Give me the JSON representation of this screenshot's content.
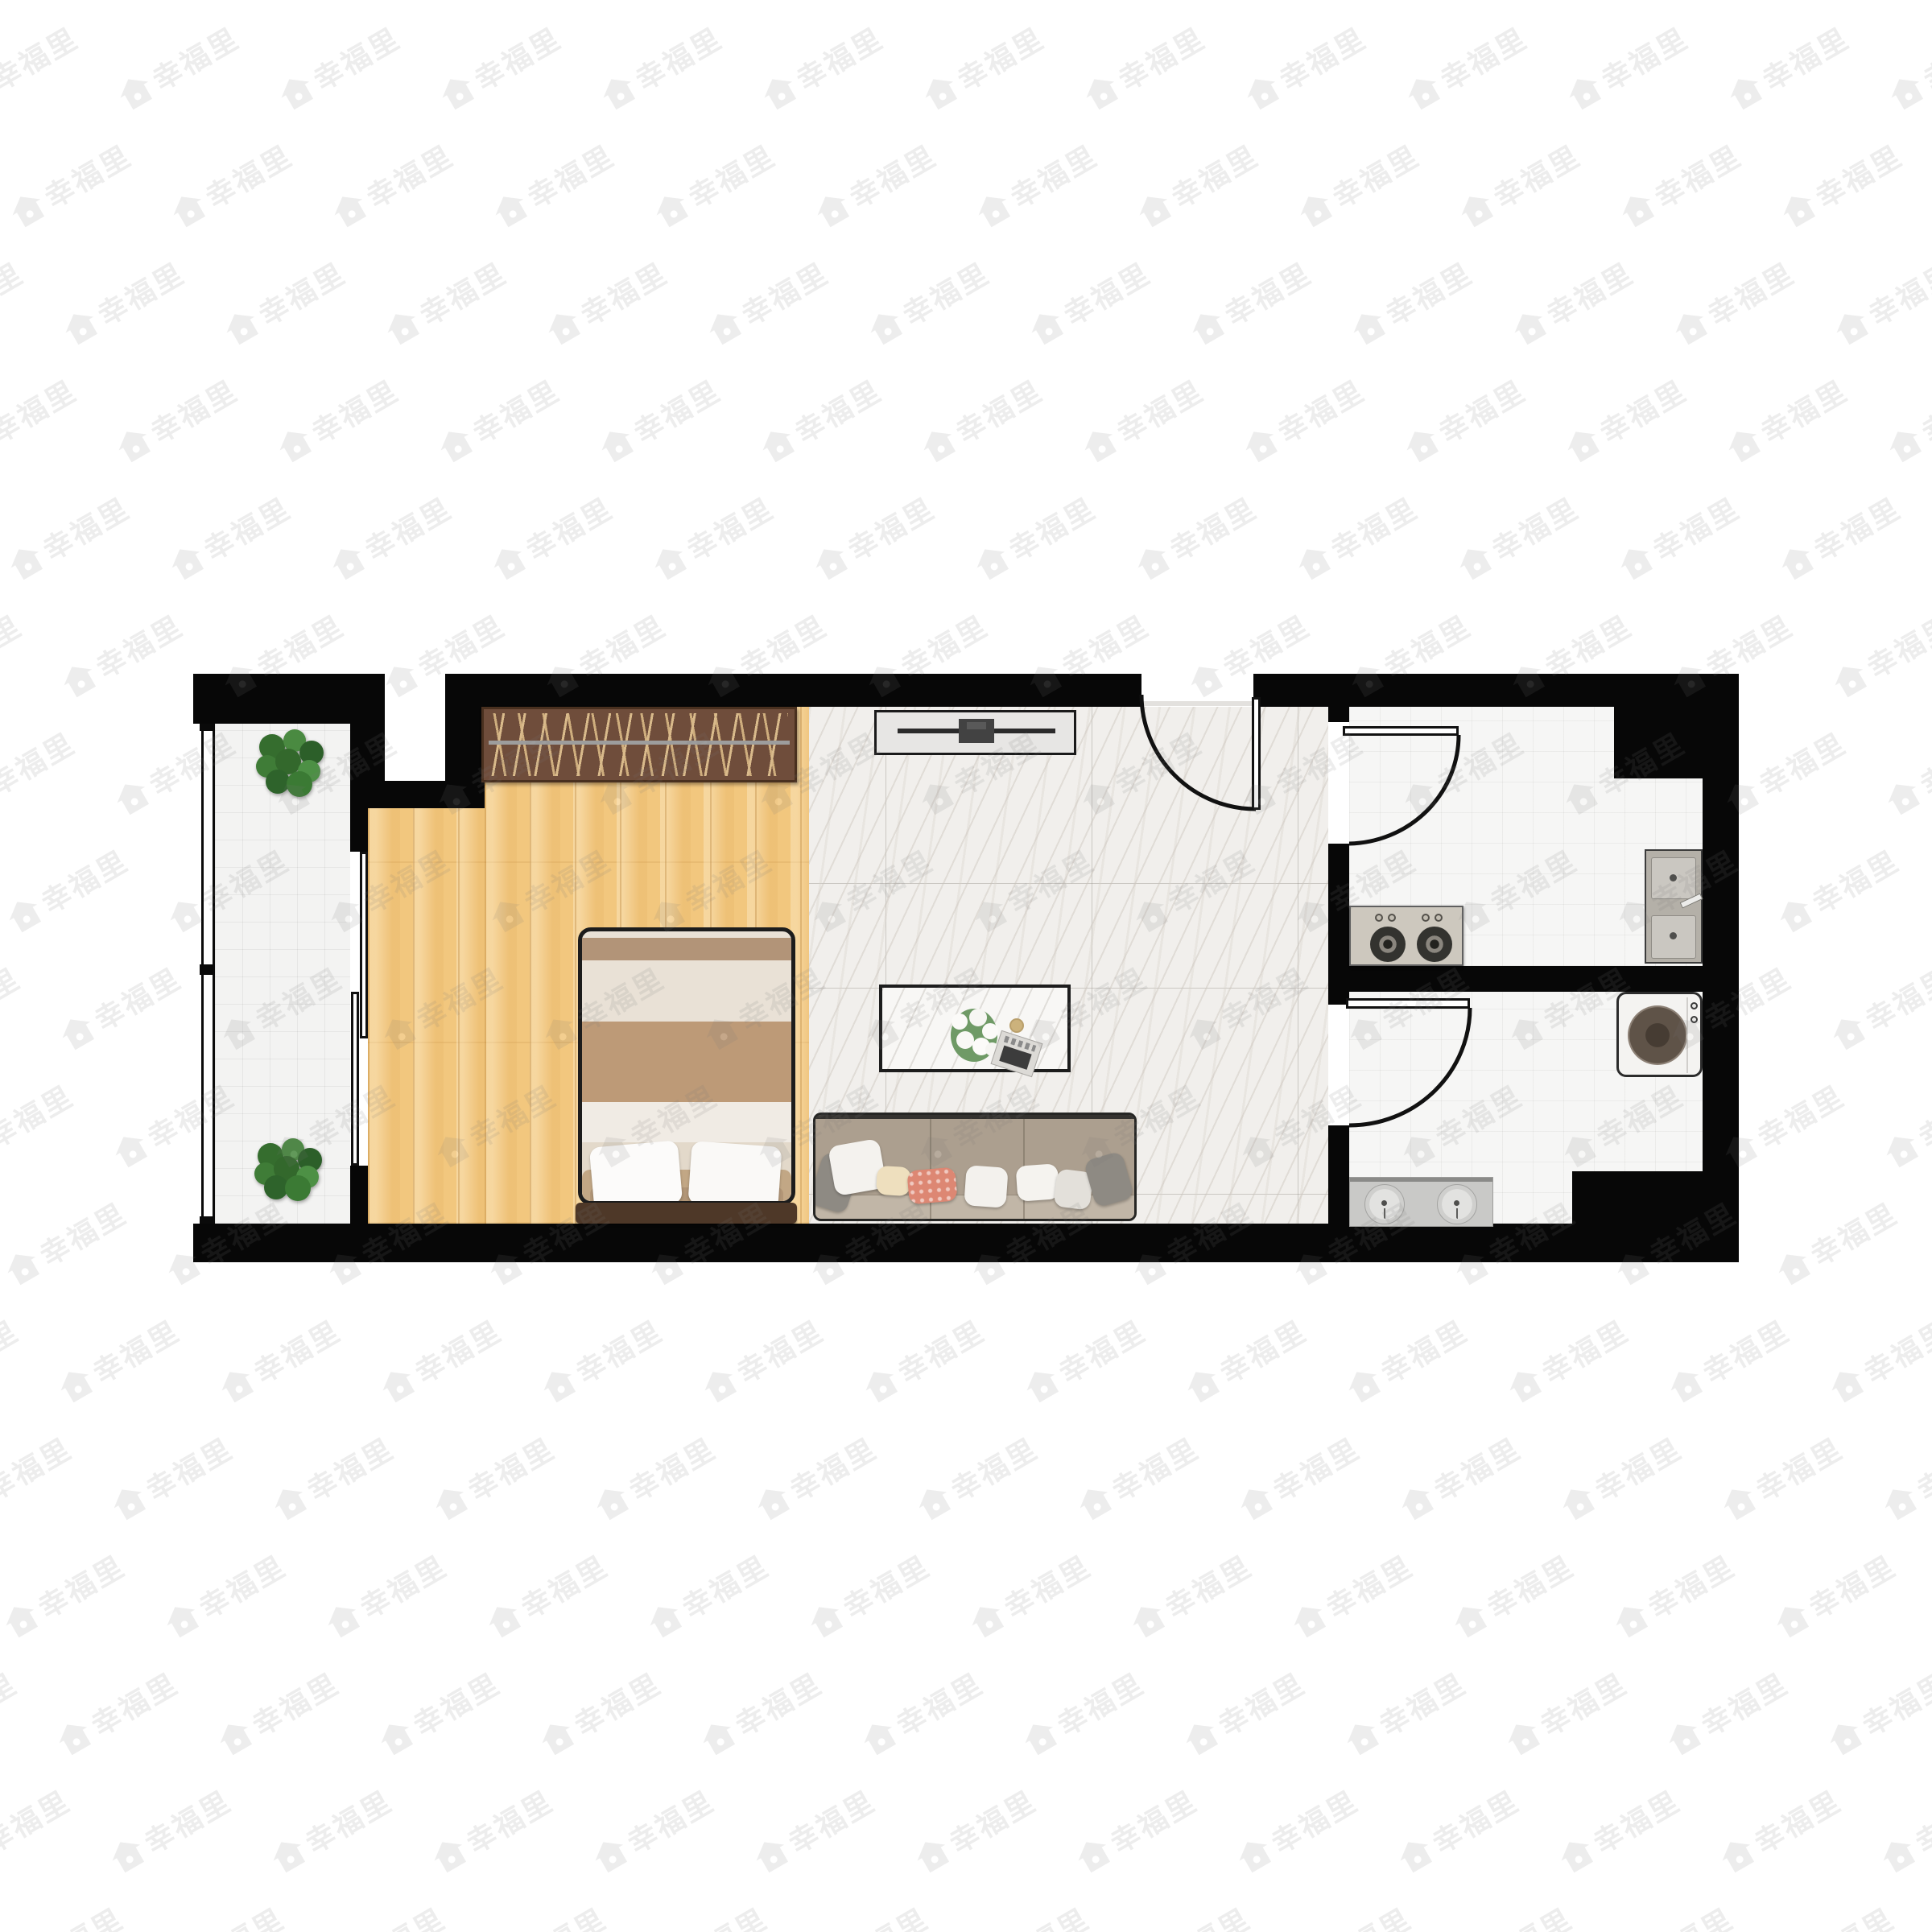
{
  "image": {
    "type": "residential-floor-plan",
    "view": "top-down furnished rendering",
    "background": "#ffffff"
  },
  "watermark": {
    "text": "幸福里",
    "icon": "house-icon",
    "color": "#787878",
    "opacity": 0.13,
    "rotation_deg": -30
  },
  "colors": {
    "wall": "#070707",
    "wood_floor": "#f2c77e",
    "marble_floor": "#f1efec",
    "white_tile_floor": "#f6f6f5",
    "wardrobe": "#6f4d3b",
    "wardrobe_hangers": "#d9ba8b",
    "sofa_body": "#b6ac9e",
    "accent_pillow_coral": "#dd8773",
    "accent_pillow_cream": "#eedfbe",
    "bed_blanket_brown": "#bd9a77",
    "footboard": "#4e3828",
    "plant_green": "#3f7c37",
    "appliance_gray": "#cdc8be"
  },
  "rooms": [
    {
      "id": "balcony",
      "floor": "white-tile",
      "furniture": [
        "potted-plant-top",
        "potted-plant-bottom"
      ],
      "features": [
        "full-height-window-left",
        "sliding-door-to-bedroom"
      ]
    },
    {
      "id": "bedroom",
      "floor": "wood-plank",
      "furniture": [
        "wardrobe-with-hangers",
        "double-bed-with-pillows",
        "footboard-bench"
      ]
    },
    {
      "id": "living-room",
      "floor": "marble-tile",
      "furniture": [
        "tv-console-with-tv",
        "coffee-table-with-flowers-and-magazine",
        "three-seat-sofa-with-pillows"
      ],
      "features": [
        "entry-door-top"
      ]
    },
    {
      "id": "kitchen",
      "floor": "white-tile",
      "furniture": [
        "two-burner-gas-stove",
        "double-basin-sink"
      ],
      "features": [
        "swing-door-from-living-room"
      ]
    },
    {
      "id": "bathroom",
      "floor": "white-tile",
      "furniture": [
        "washing-machine",
        "double-sink-vanity"
      ],
      "features": [
        "swing-door-from-living-room"
      ]
    }
  ],
  "doors": [
    {
      "id": "entry-door",
      "type": "swing",
      "location": "top wall of living room"
    },
    {
      "id": "kitchen-door",
      "type": "swing",
      "location": "wall between living room and kitchen"
    },
    {
      "id": "bathroom-door",
      "type": "swing",
      "location": "wall between living room and bathroom"
    },
    {
      "id": "balcony-sliding-door",
      "type": "sliding",
      "location": "wall between balcony and bedroom"
    }
  ]
}
